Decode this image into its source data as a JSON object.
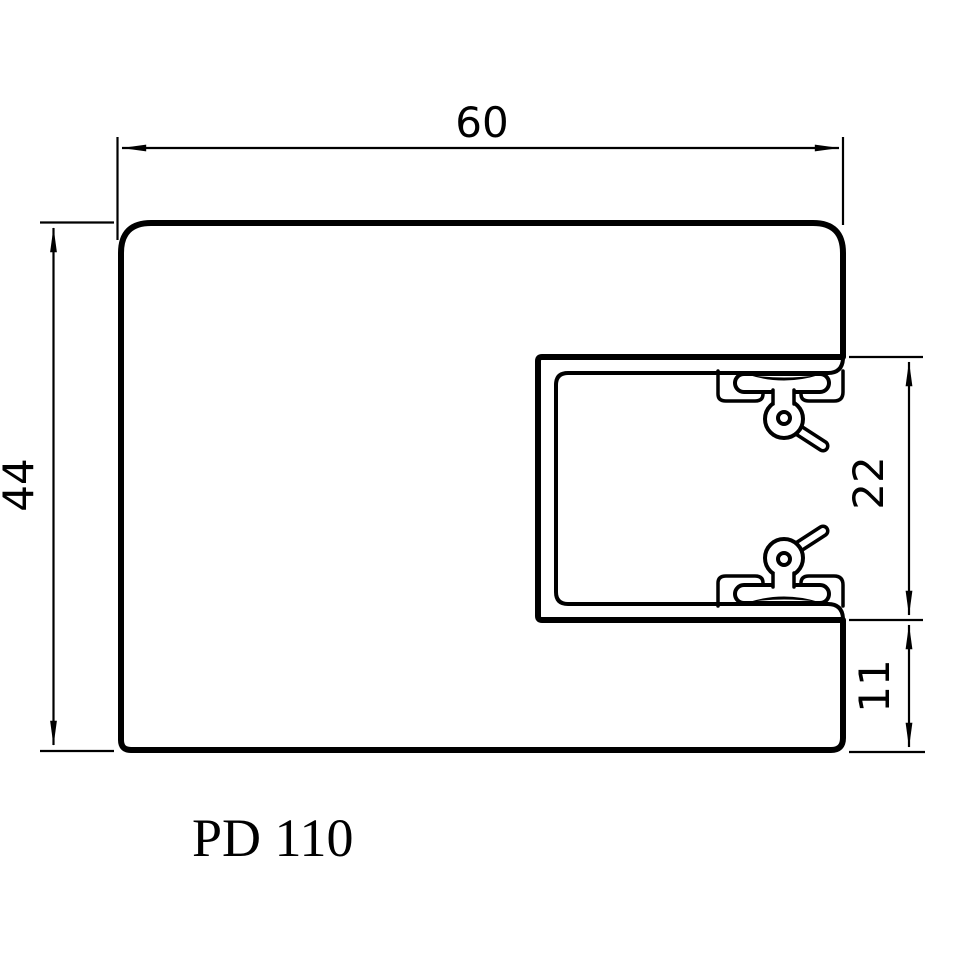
{
  "meta": {
    "ink_color": "#000000",
    "paper_color": "#ffffff"
  },
  "labels": {
    "title": "PD 110"
  },
  "dims": {
    "top_width": "60",
    "left_height": "44",
    "slot_height": "22",
    "bottom_lip": "11"
  }
}
